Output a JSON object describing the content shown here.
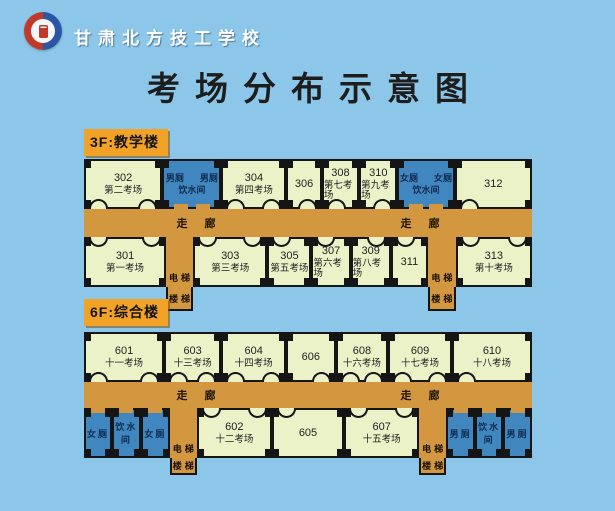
{
  "header": {
    "school_name": "甘肃北方技工学校",
    "logo": "school-badge-icon"
  },
  "title": "考场分布示意图",
  "colors": {
    "sky_background": "#8CC6E8",
    "corridor_floor": "#D2973F",
    "exam_room": "#ECF2C8",
    "wet_room": "#4187BF",
    "floor_label_bg": "#F2A227",
    "wall": "#151515"
  },
  "labels": {
    "corridor": "走廊",
    "elevator": "电梯",
    "stairs": "楼梯"
  },
  "floors": [
    {
      "label": "3F:教学楼",
      "top": [
        {
          "num": "302",
          "sub": "第二考场"
        },
        {
          "wet1": "男厕",
          "wet2": "男厕",
          "wet3": "饮水间"
        },
        {
          "num": "304",
          "sub": "第四考场"
        },
        {
          "num": "306",
          "sub": ""
        },
        {
          "num": "308",
          "sub": "第七考场"
        },
        {
          "num": "310",
          "sub": "第九考场"
        },
        {
          "wet1": "女厕",
          "wet2": "女厕",
          "wet3": "饮水间"
        },
        {
          "num": "312",
          "sub": ""
        }
      ],
      "bottom": [
        {
          "num": "301",
          "sub": "第一考场"
        },
        {
          "num": "303",
          "sub": "第三考场"
        },
        {
          "num": "305",
          "sub": "第五考场"
        },
        {
          "num": "307",
          "sub": "第六考场"
        },
        {
          "num": "309",
          "sub": "第八考场"
        },
        {
          "num": "311",
          "sub": ""
        },
        {
          "num": "313",
          "sub": "第十考场"
        }
      ]
    },
    {
      "label": "6F:综合楼",
      "top": [
        {
          "num": "601",
          "sub": "十一考场"
        },
        {
          "num": "603",
          "sub": "十三考场"
        },
        {
          "num": "604",
          "sub": "十四考场"
        },
        {
          "num": "606",
          "sub": ""
        },
        {
          "num": "608",
          "sub": "十六考场"
        },
        {
          "num": "609",
          "sub": "十七考场"
        },
        {
          "num": "610",
          "sub": "十八考场"
        }
      ],
      "bottom": [
        {
          "wet": "女厕"
        },
        {
          "wet": "饮水间"
        },
        {
          "wet": "女厕"
        },
        {
          "num": "602",
          "sub": "十二考场"
        },
        {
          "num": "605",
          "sub": ""
        },
        {
          "num": "607",
          "sub": "十五考场"
        },
        {
          "wet": "男厕"
        },
        {
          "wet": "饮水间"
        },
        {
          "wet": "男厕"
        }
      ]
    }
  ]
}
